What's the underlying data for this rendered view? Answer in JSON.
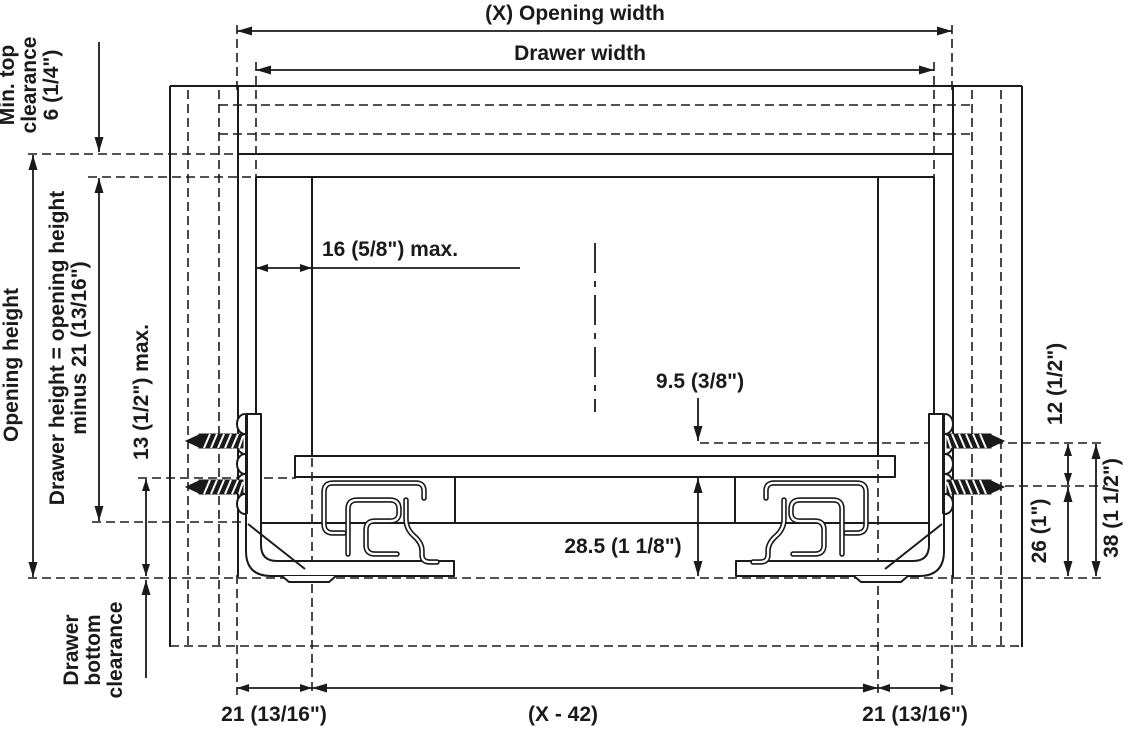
{
  "diagram_title": "Drawer slide installation cross-section",
  "colors": {
    "line": "#1a1a1a",
    "background": "#ffffff"
  },
  "dims": {
    "opening_width": "(X) Opening width",
    "drawer_width": "Drawer width",
    "min_top_clearance": [
      "Min. top",
      "clearance",
      "6 (1/4\")"
    ],
    "opening_height": "Opening height",
    "drawer_height": [
      "Drawer height = opening height",
      "minus 21 (13/16\")"
    ],
    "thirteen_max": "13 (1/2\") max.",
    "drawer_bottom_clearance": [
      "Drawer",
      "bottom",
      "clearance"
    ],
    "sixteen_max": "16 (5/8\") max.",
    "nine_point_five": "9.5 (3/8\")",
    "twenty_eight_point_five": "28.5 (1 1/8\")",
    "twelve": "12 (1/2\")",
    "twenty_six": "26 (1\")",
    "thirty_eight": "38 (1 1/2\")",
    "left_21": "21 (13/16\")",
    "x_minus_42": "(X - 42)",
    "right_21": "21 (13/16\")"
  }
}
